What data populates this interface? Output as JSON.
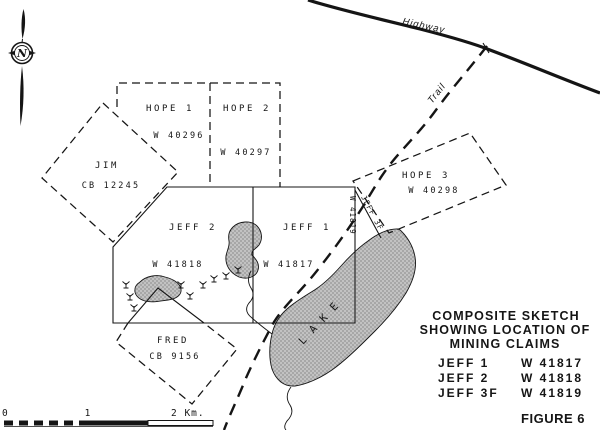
{
  "map_title": {
    "lines": [
      "COMPOSITE SKETCH",
      "SHOWING LOCATION OF",
      "MINING CLAIMS"
    ]
  },
  "legend_entries": [
    {
      "claim": "JEFF 1",
      "number": "W 41817"
    },
    {
      "claim": "JEFF 2",
      "number": "W 41818"
    },
    {
      "claim": "JEFF 3F",
      "number": "W 41819"
    }
  ],
  "figure_label": "FIGURE 6",
  "claims": {
    "hope1": {
      "name": "HOPE 1",
      "number": "W 40296"
    },
    "hope2": {
      "name": "HOPE 2",
      "number": "W 40297"
    },
    "hope3": {
      "name": "HOPE 3",
      "number": "W 40298"
    },
    "jim": {
      "name": "JIM",
      "number": "CB 12245"
    },
    "jeff1": {
      "name": "JEFF 1",
      "number": "W 41817"
    },
    "jeff2": {
      "name": "JEFF 2",
      "number": "W 41818"
    },
    "jeff3f": {
      "name": "JEFF 3F",
      "number": "W 41819"
    },
    "fred": {
      "name": "FRED",
      "number": "CB 9156"
    }
  },
  "features": {
    "highway": "Highway",
    "trail": "Trail",
    "lake": "LAKE"
  },
  "scale_bar": {
    "zero": "0",
    "one": "1",
    "two": "2 Km."
  },
  "compass": {
    "north": "N"
  },
  "colors": {
    "ink": "#151515",
    "lake_gray": "#c2c2c2",
    "stipple_dot": "#6e6e6e",
    "paper": "#ffffff"
  }
}
